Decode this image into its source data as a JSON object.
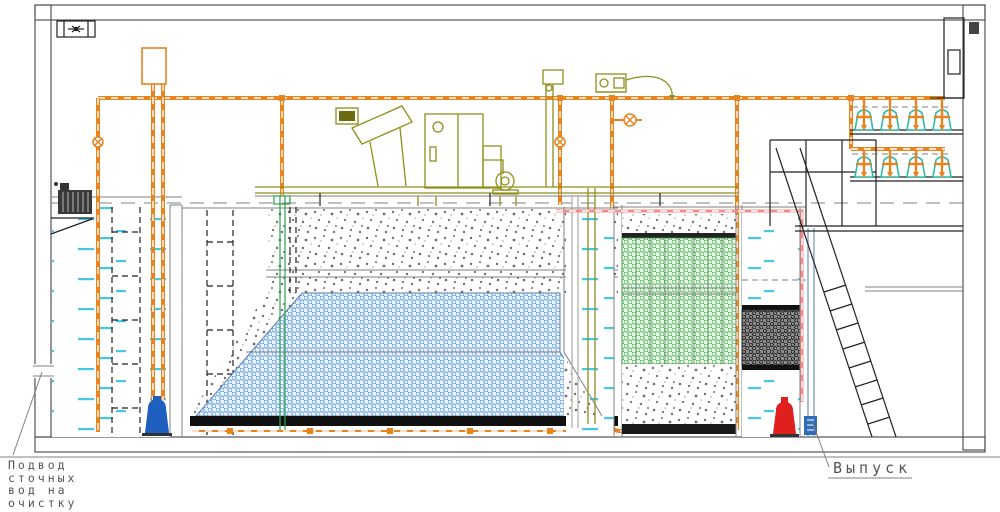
{
  "labels": {
    "inlet_lines": [
      "Подвод",
      "сточных",
      "вод на",
      "очистку"
    ],
    "outlet": "Выпуск"
  },
  "icons": {
    "roof_fan": "fan-icon"
  },
  "colors": {
    "pipe_orange": "#E8831E",
    "pipe_core_brown": "#7A3A10",
    "equipment_olive": "#8F8F1A",
    "water_cyan": "#45C8E8",
    "media_blue": "#4A90D9",
    "media_green": "#3FAE49",
    "pump_blue": "#1F5FBF",
    "pump_red": "#E01F1F",
    "blower_teal": "#2FB9A8",
    "pipe_pink": "#F08C8C",
    "line_gray": "#6E6E6E",
    "text_gray": "#555555"
  }
}
